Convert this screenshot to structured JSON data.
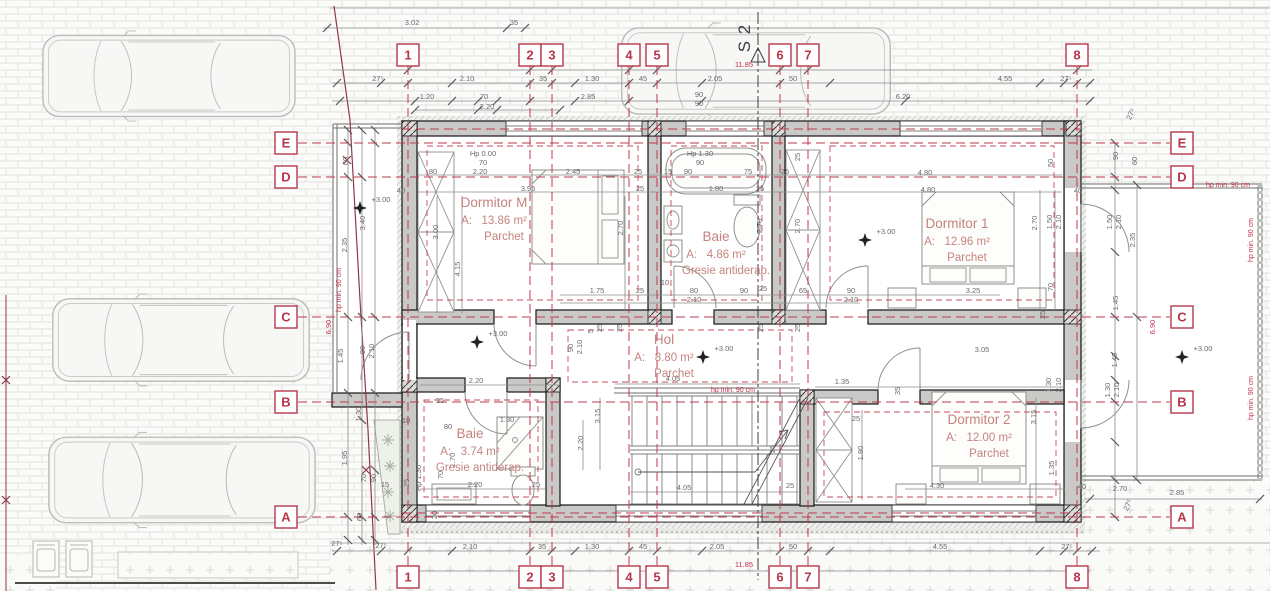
{
  "section": {
    "label": "S 2",
    "x": 750,
    "y": 38
  },
  "colors": {
    "axis_red": "#b7374a",
    "annotation_red": "#c0314c",
    "room_text": "#c5837e",
    "dim_text": "#6a6a6a",
    "wall_fill": "#c9c9c7"
  },
  "grid": {
    "cols": [
      {
        "label": "1",
        "x": 408
      },
      {
        "label": "2",
        "x": 530
      },
      {
        "label": "3",
        "x": 552
      },
      {
        "label": "4",
        "x": 629
      },
      {
        "label": "5",
        "x": 657
      },
      {
        "label": "6",
        "x": 780
      },
      {
        "label": "7",
        "x": 808
      },
      {
        "label": "8",
        "x": 1077
      }
    ],
    "rows": [
      {
        "label": "E",
        "y": 143
      },
      {
        "label": "D",
        "y": 177
      },
      {
        "label": "C",
        "y": 317
      },
      {
        "label": "B",
        "y": 402
      },
      {
        "label": "A",
        "y": 517
      }
    ],
    "top_y": 55,
    "bottom_y": 577,
    "left_x": 286,
    "right_x": 1182
  },
  "rooms": [
    {
      "name": "Dormitor M",
      "area_prefix": "A:",
      "area": "13.86 m²",
      "floor": "Parchet",
      "x": 494,
      "y": 207
    },
    {
      "name": "Baie",
      "area_prefix": "A:",
      "area": "4.86 m²",
      "floor": "Gresie antiderap.",
      "x": 716,
      "y": 241
    },
    {
      "name": "Dormitor 1",
      "area_prefix": "A:",
      "area": "12.96 m²",
      "floor": "Parchet",
      "x": 957,
      "y": 228
    },
    {
      "name": "Hol",
      "area_prefix": "A:",
      "area": "8.80 m²",
      "floor": "Parchet",
      "x": 664,
      "y": 344
    },
    {
      "name": "Baie",
      "area_prefix": "A:",
      "area": "3.74 m²",
      "floor": "Gresie antiderap.",
      "x": 470,
      "y": 438
    },
    {
      "name": "Dormitor 2",
      "area_prefix": "A:",
      "area": "12.00 m²",
      "floor": "Parchet",
      "x": 979,
      "y": 424
    }
  ],
  "elevation_markers": [
    {
      "label": "+3.00",
      "x": 477,
      "y": 342
    },
    {
      "label": "+3.00",
      "x": 703,
      "y": 357
    },
    {
      "label": "+3.00",
      "x": 865,
      "y": 240
    },
    {
      "label": "+3.00",
      "x": 360,
      "y": 208
    },
    {
      "label": "+3.00",
      "x": 1182,
      "y": 357
    }
  ],
  "annotations": [
    [
      "3.02",
      412,
      25
    ],
    [
      "35",
      514,
      25
    ],
    [
      "27⁵",
      378,
      81
    ],
    [
      "2.10",
      467,
      81
    ],
    [
      "35",
      543,
      81
    ],
    [
      "1.30",
      592,
      81
    ],
    [
      "45",
      643,
      81
    ],
    [
      "2.05",
      715,
      81
    ],
    [
      "50",
      793,
      81
    ],
    [
      "4.55",
      1005,
      81
    ],
    [
      "27⁵",
      1066,
      81
    ],
    [
      "1.20",
      427,
      99
    ],
    [
      "70",
      484,
      99
    ],
    [
      "2.20",
      487,
      109
    ],
    [
      "2.85",
      588,
      99
    ],
    [
      "90",
      699,
      97
    ],
    [
      "90",
      699,
      106
    ],
    [
      "6.20",
      903,
      99
    ],
    [
      "11.85",
      744,
      67,
      0,
      "r"
    ],
    [
      "50",
      1053,
      163,
      -90
    ],
    [
      "27⁵",
      1133,
      115,
      -65
    ],
    [
      "90",
      1118,
      156,
      -90
    ],
    [
      "60",
      1137,
      161,
      -90
    ],
    [
      "40",
      1078,
      193
    ],
    [
      "hp min. 90 cm",
      1228,
      187,
      0,
      "s"
    ],
    [
      "Hp 0.00",
      483,
      156,
      0,
      "d",
      6.5
    ],
    [
      "70",
      483,
      165
    ],
    [
      "2.20",
      480,
      174
    ],
    [
      "80",
      433,
      174
    ],
    [
      "2.45",
      573,
      174
    ],
    [
      "25",
      638,
      174
    ],
    [
      "3.95",
      528,
      191
    ],
    [
      "25",
      640,
      191
    ],
    [
      "40",
      401,
      193
    ],
    [
      "Hp 1.30",
      700,
      156,
      0,
      "d",
      6.5
    ],
    [
      "90",
      700,
      165
    ],
    [
      "15",
      668,
      174
    ],
    [
      "90",
      688,
      174
    ],
    [
      "75",
      748,
      174
    ],
    [
      "25",
      785,
      174
    ],
    [
      "1.80",
      716,
      191
    ],
    [
      "25",
      760,
      191
    ],
    [
      "4.80",
      925,
      175
    ],
    [
      "4.80",
      928,
      192
    ],
    [
      "25",
      800,
      157,
      -90
    ],
    [
      "3.00",
      438,
      232,
      -90
    ],
    [
      "4.15",
      460,
      269,
      -90
    ],
    [
      "2.70",
      623,
      228,
      -90
    ],
    [
      "2.70",
      762,
      226,
      -90
    ],
    [
      "2.70",
      800,
      226,
      -90
    ],
    [
      "2.70",
      1037,
      223,
      -90
    ],
    [
      "1.50",
      1052,
      222,
      -90
    ],
    [
      "2.10",
      1061,
      222,
      -90
    ],
    [
      "1.50",
      1112,
      222,
      -90
    ],
    [
      "2.10",
      1121,
      222,
      -90
    ],
    [
      "2.35",
      1135,
      240,
      -90
    ],
    [
      "60",
      348,
      161,
      -90
    ],
    [
      "3.40",
      365,
      223,
      -90
    ],
    [
      "2.35",
      347,
      245,
      -90
    ],
    [
      "hp min. 90 cm",
      341,
      290,
      -90,
      "s"
    ],
    [
      "6.90",
      331,
      327,
      -90,
      "r"
    ],
    [
      "hp min. 90 cm",
      1253,
      240,
      -90,
      "s"
    ],
    [
      "6.90",
      1155,
      327,
      -90,
      "r"
    ],
    [
      "hp min. 90 cm",
      1253,
      398,
      -90,
      "s"
    ],
    [
      "70",
      1053,
      287,
      -90
    ],
    [
      "25",
      1045,
      315,
      -90
    ],
    [
      "1.45",
      1118,
      303,
      -90
    ],
    [
      "1.45",
      1117,
      360,
      -90
    ],
    [
      "1.75",
      597,
      293
    ],
    [
      "25",
      640,
      293
    ],
    [
      "10",
      665,
      285
    ],
    [
      "80",
      694,
      293
    ],
    [
      "2.10",
      694,
      302
    ],
    [
      "90",
      744,
      293
    ],
    [
      "25",
      763,
      291
    ],
    [
      "65",
      803,
      293
    ],
    [
      "90",
      851,
      293
    ],
    [
      "2.10",
      851,
      302
    ],
    [
      "3.25",
      973,
      293
    ],
    [
      "3.05",
      982,
      352
    ],
    [
      "90",
      573,
      348,
      -90
    ],
    [
      "2.10",
      582,
      347,
      -90
    ],
    [
      "5",
      593,
      331,
      -90
    ],
    [
      "25",
      602,
      328,
      -90
    ],
    [
      "25",
      622,
      328,
      -90
    ],
    [
      "25",
      763,
      328,
      -90
    ],
    [
      "25",
      800,
      328,
      -90
    ],
    [
      "4.05",
      673,
      381
    ],
    [
      "hp min. 90 cm",
      733,
      392,
      0,
      "s"
    ],
    [
      "3.15",
      600,
      416,
      -90
    ],
    [
      "2.20",
      476,
      383
    ],
    [
      "1.35",
      842,
      384
    ],
    [
      "35",
      900,
      391,
      -90
    ],
    [
      "25",
      856,
      421
    ],
    [
      "1.80",
      863,
      453,
      -90
    ],
    [
      "3.15",
      1036,
      417,
      -90
    ],
    [
      "1.30",
      1051,
      385,
      -90
    ],
    [
      "2.10",
      1061,
      385,
      -90
    ],
    [
      "1.30",
      1110,
      390,
      -90
    ],
    [
      "2.10",
      1119,
      390,
      -90
    ],
    [
      "1.35",
      1054,
      468,
      -90
    ],
    [
      "4.30",
      937,
      488
    ],
    [
      "40",
      1082,
      489
    ],
    [
      "2.70",
      1120,
      491
    ],
    [
      "1.30",
      507,
      422
    ],
    [
      "80",
      448,
      429
    ],
    [
      "25",
      440,
      403
    ],
    [
      "10",
      406,
      423
    ],
    [
      "1.70",
      455,
      460,
      -90
    ],
    [
      "70",
      443,
      475,
      -90
    ],
    [
      "Hp 1.30",
      421,
      478,
      -90,
      "d",
      6.5
    ],
    [
      "2.20",
      475,
      487
    ],
    [
      "25",
      536,
      487
    ],
    [
      "2.20",
      583,
      443,
      -90
    ],
    [
      "20",
      437,
      515,
      -90
    ],
    [
      "25",
      409,
      483,
      -90
    ],
    [
      "4.05",
      684,
      490
    ],
    [
      "25",
      790,
      488
    ],
    [
      "25",
      775,
      449,
      -90
    ],
    [
      "1.95",
      347,
      458,
      -90
    ],
    [
      "1.30",
      361,
      414,
      -90
    ],
    [
      "1.45",
      343,
      356,
      -90
    ],
    [
      "90",
      365,
      350,
      -90
    ],
    [
      "2.10",
      374,
      351,
      -90
    ],
    [
      "70",
      366,
      478,
      -90
    ],
    [
      "90",
      376,
      478,
      -90
    ],
    [
      "15",
      385,
      487
    ],
    [
      "60",
      362,
      517,
      -90
    ],
    [
      "27⁵",
      337,
      546
    ],
    [
      "27⁵",
      381,
      548
    ],
    [
      "2.10",
      470,
      549
    ],
    [
      "35",
      542,
      549
    ],
    [
      "1.30",
      592,
      549
    ],
    [
      "45",
      643,
      549
    ],
    [
      "2.05",
      717,
      549
    ],
    [
      "50",
      793,
      549
    ],
    [
      "4.55",
      940,
      549
    ],
    [
      "27⁵",
      1067,
      549
    ],
    [
      "11.85",
      744,
      567,
      0,
      "r"
    ],
    [
      "2.85",
      1177,
      495
    ],
    [
      "27⁵",
      1130,
      506,
      -65
    ]
  ]
}
